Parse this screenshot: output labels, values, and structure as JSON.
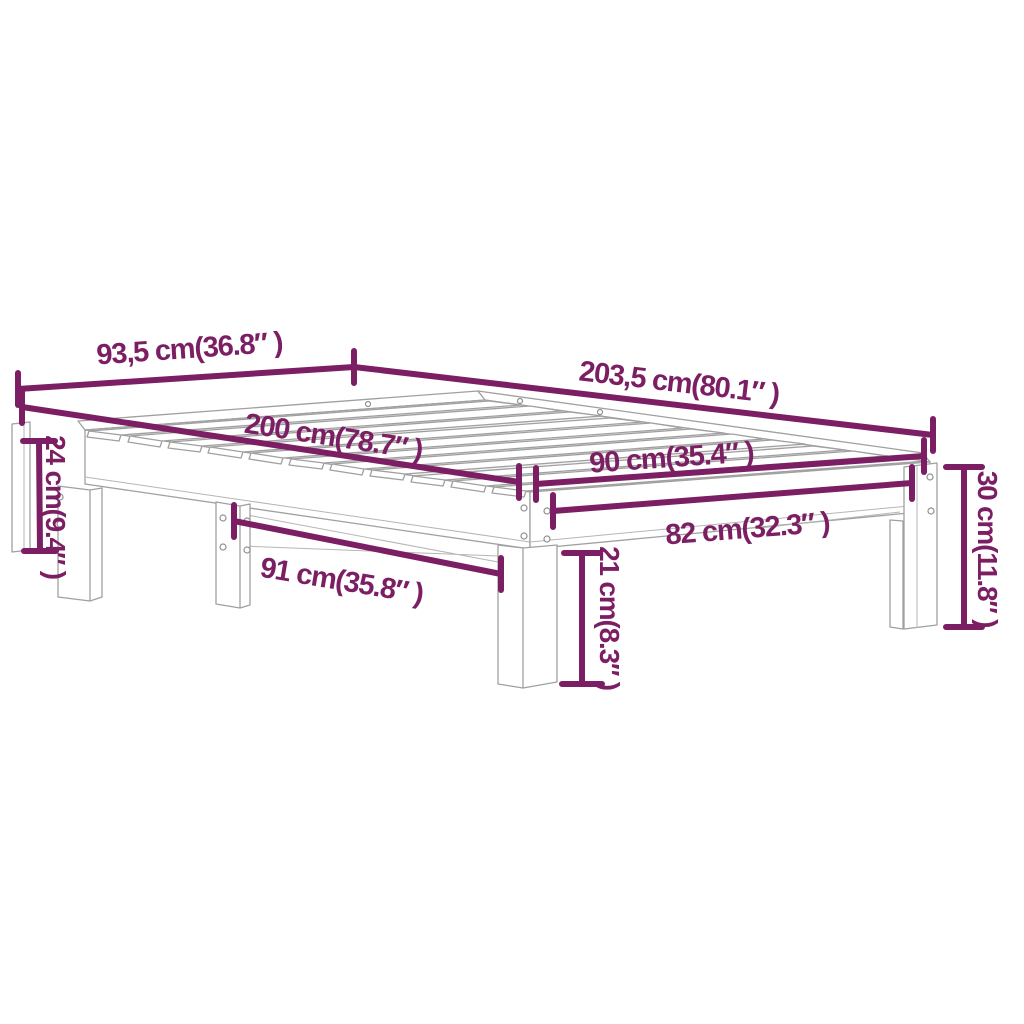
{
  "diagram": {
    "type": "product-dimension-diagram",
    "subject": "slatted-bed-frame",
    "background_color": "#ffffff",
    "accent_color": "#7c1e63",
    "drawing_line_color": "#a0a0a0",
    "dimensions": [
      {
        "id": "outer-width-foot",
        "label": "93,5 cm(36.8″ )",
        "value_cm": 93.5,
        "value_in": 36.8
      },
      {
        "id": "outer-length",
        "label": "203,5 cm(80.1″ )",
        "value_cm": 203.5,
        "value_in": 80.1
      },
      {
        "id": "inner-length",
        "label": "200 cm(78.7″ )",
        "value_cm": 200,
        "value_in": 78.7
      },
      {
        "id": "inner-width-head",
        "label": "90 cm(35.4″ )",
        "value_cm": 90,
        "value_in": 35.4
      },
      {
        "id": "head-rail-span",
        "label": "82 cm(32.3″ )",
        "value_cm": 82,
        "value_in": 32.3
      },
      {
        "id": "side-rail-span",
        "label": "91 cm(35.8″ )",
        "value_cm": 91,
        "value_in": 35.8
      },
      {
        "id": "foot-leg-height",
        "label": "24 cm(9.4″ )",
        "value_cm": 24,
        "value_in": 9.4
      },
      {
        "id": "total-height",
        "label": "30 cm(11.8″ )",
        "value_cm": 30,
        "value_in": 11.8
      },
      {
        "id": "under-clearance",
        "label": "21 cm(8.3″ )",
        "value_cm": 21,
        "value_in": 8.3
      }
    ]
  }
}
